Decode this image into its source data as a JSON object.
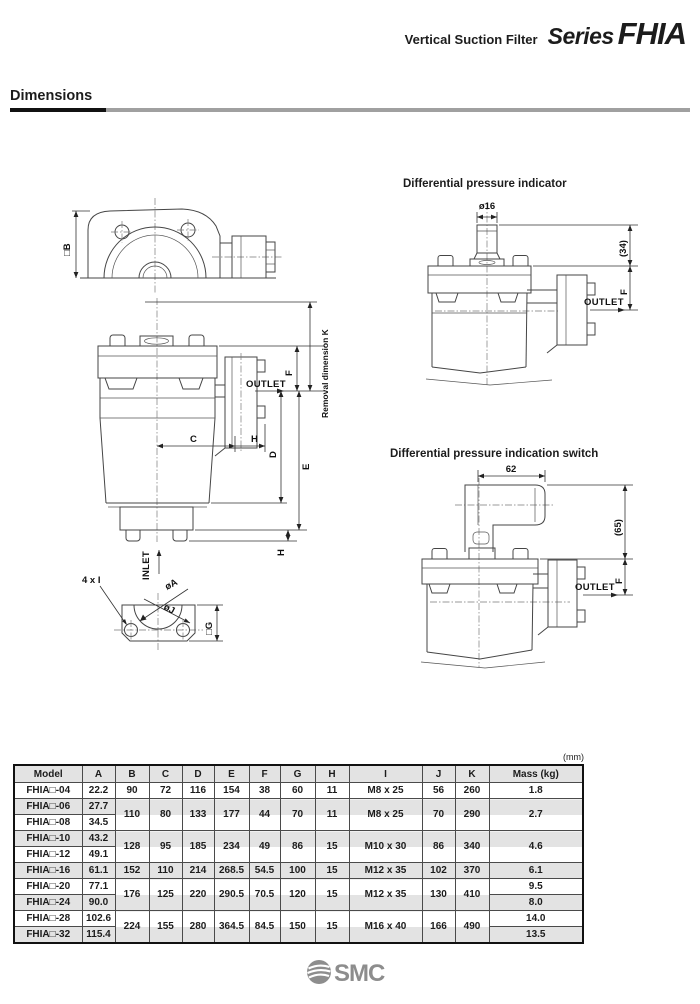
{
  "header": {
    "product": "Vertical Suction Filter",
    "series_label": "Series",
    "series_name": "FHIA"
  },
  "section": {
    "title": "Dimensions"
  },
  "diagrams": {
    "top_view": {
      "dim_b": "□B"
    },
    "front_view": {
      "outlet": "OUTLET",
      "inlet": "INLET",
      "dim_f": "F",
      "dim_e": "E",
      "dim_d": "D",
      "dim_c": "C",
      "dim_h_side": "H",
      "dim_h_bottom": "H",
      "removal": "Removal dimension K"
    },
    "bottom_view": {
      "holes": "4 x I",
      "dia_a": "øA",
      "dia_j": "øJ",
      "dim_g": "□G"
    },
    "indicator": {
      "title": "Differential pressure indicator",
      "dia16": "ø16",
      "dim34": "(34)",
      "dim_f": "F",
      "outlet": "OUTLET"
    },
    "switch": {
      "title": "Differential pressure indication switch",
      "dim62": "62",
      "dim65": "(65)",
      "dim_f": "F",
      "outlet": "OUTLET"
    }
  },
  "table": {
    "unit_label": "(mm)",
    "headers": {
      "model": "Model",
      "a": "A",
      "b": "B",
      "c": "C",
      "d": "D",
      "e": "E",
      "f": "F",
      "g": "G",
      "h": "H",
      "i": "I",
      "j": "J",
      "k": "K",
      "mass": "Mass (kg)"
    },
    "rows": {
      "r04": {
        "model": "FHIA□-04",
        "a": "22.2",
        "b": "90",
        "c": "72",
        "d": "116",
        "e": "154",
        "f": "38",
        "g": "60",
        "h": "11",
        "i": "M8 x 25",
        "j": "56",
        "k": "260",
        "mass": "1.8"
      },
      "r06": {
        "model": "FHIA□-06",
        "a": "27.7"
      },
      "r08": {
        "model": "FHIA□-08",
        "a": "34.5"
      },
      "g0608": {
        "b": "110",
        "c": "80",
        "d": "133",
        "e": "177",
        "f": "44",
        "g": "70",
        "h": "11",
        "i": "M8 x 25",
        "j": "70",
        "k": "290",
        "mass": "2.7"
      },
      "r10": {
        "model": "FHIA□-10",
        "a": "43.2"
      },
      "r12": {
        "model": "FHIA□-12",
        "a": "49.1"
      },
      "g1012": {
        "b": "128",
        "c": "95",
        "d": "185",
        "e": "234",
        "f": "49",
        "g": "86",
        "h": "15",
        "i": "M10 x 30",
        "j": "86",
        "k": "340",
        "mass": "4.6"
      },
      "r16": {
        "model": "FHIA□-16",
        "a": "61.1",
        "b": "152",
        "c": "110",
        "d": "214",
        "e": "268.5",
        "f": "54.5",
        "g": "100",
        "h": "15",
        "i": "M12 x 35",
        "j": "102",
        "k": "370",
        "mass": "6.1"
      },
      "r20": {
        "model": "FHIA□-20",
        "a": "77.1",
        "mass": "9.5"
      },
      "r24": {
        "model": "FHIA□-24",
        "a": "90.0",
        "mass": "8.0"
      },
      "g2024": {
        "b": "176",
        "c": "125",
        "d": "220",
        "e": "290.5",
        "f": "70.5",
        "g": "120",
        "h": "15",
        "i": "M12 x 35",
        "j": "130",
        "k": "410"
      },
      "r28": {
        "model": "FHIA□-28",
        "a": "102.6",
        "mass": "14.0"
      },
      "r32": {
        "model": "FHIA□-32",
        "a": "115.4",
        "mass": "13.5"
      },
      "g2832": {
        "b": "224",
        "c": "155",
        "d": "280",
        "e": "364.5",
        "f": "84.5",
        "g": "150",
        "h": "15",
        "i": "M16 x 40",
        "j": "166",
        "k": "490"
      }
    }
  },
  "footer": {
    "logo_text": "SMC"
  },
  "colors": {
    "stripe_gray": "#e3e3e3",
    "logo_gray": "#8d8d8d",
    "rule_gray": "#a0a0a0"
  }
}
